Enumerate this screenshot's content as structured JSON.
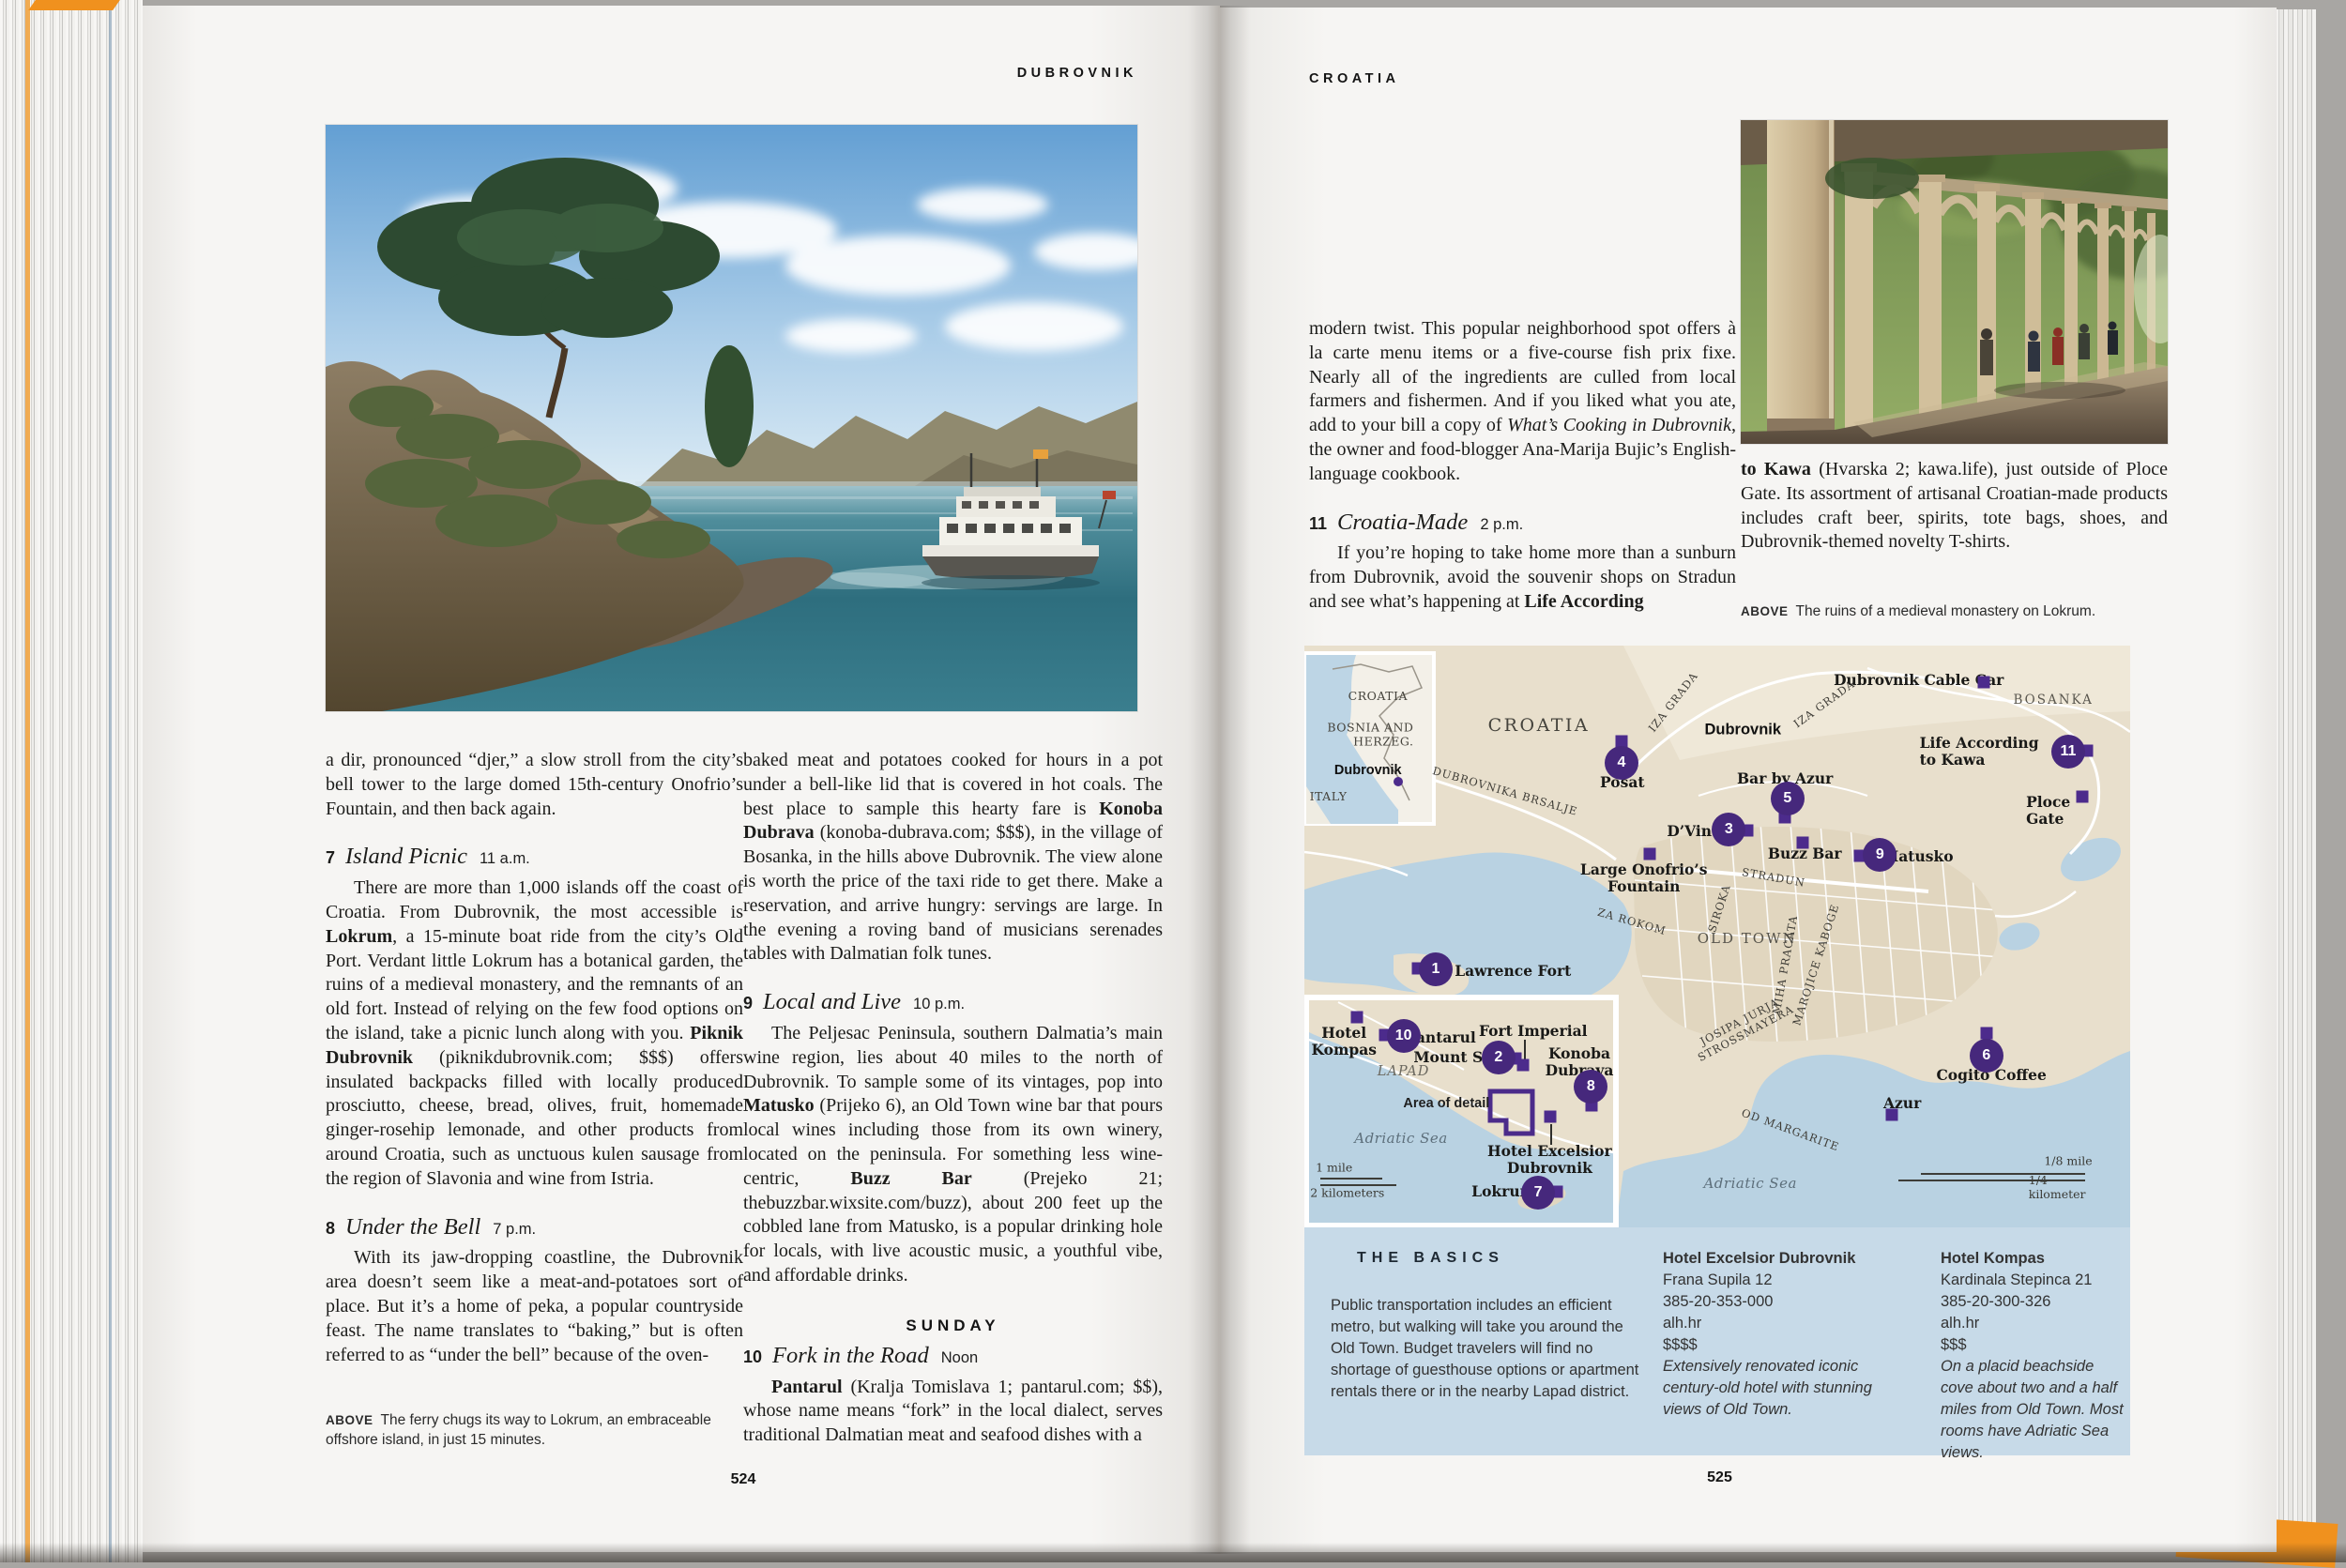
{
  "chrome": {
    "left_header": "DUBROVNIK",
    "right_header": "CROATIA",
    "left_page_number": "524",
    "right_page_number": "525"
  },
  "left_page": {
    "intro": [
      {
        "t": "a dir, pronounced “djer,” a slow stroll from the city’s bell tower to the large domed 15th-century Onofrio’s Fountain, and then back again."
      }
    ],
    "item7": {
      "num": "7",
      "title": "Island Picnic",
      "time": "11 a.m.",
      "body": [
        {
          "t": "There are more than 1,000 islands off the coast of Croatia. From Dubrovnik, the most accessible is "
        },
        {
          "t": "Lokrum",
          "s": "b"
        },
        {
          "t": ", a 15-minute boat ride from the city’s Old Port. Verdant little Lokrum has a botanical garden, the ruins of a medieval monastery, and the remnants of an old fort. Instead of relying on the few food options on the island, take a picnic lunch along with you. "
        },
        {
          "t": "Piknik Dubrovnik",
          "s": "b"
        },
        {
          "t": " (piknikdubrovnik.com; $$$) offers insulated backpacks filled with locally produced prosciutto, cheese, bread, olives, fruit, homemade ginger-rosehip lemonade, and other products from around Croatia, such as unctuous kulen sausage from the region of Slavonia and wine from Istria."
        }
      ]
    },
    "item8": {
      "num": "8",
      "title": "Under the Bell",
      "time": "7 p.m.",
      "body": [
        {
          "t": "With its jaw-dropping coastline, the Dubrovnik area doesn’t seem like a meat-and-potatoes sort of place. But it’s a home of peka, a popular countryside feast. The name translates to “baking,” but is often referred to as “under the bell” because of the oven-"
        }
      ]
    },
    "caption_label": "ABOVE",
    "caption_text": "The ferry chugs its way to Lokrum, an embraceable offshore island, in just 15 minutes.",
    "col2_para": [
      {
        "t": "baked meat and potatoes cooked for hours in a pot under a bell-like lid that is covered in hot coals. The best place to sample this hearty fare is "
      },
      {
        "t": "Konoba Dubrava",
        "s": "b"
      },
      {
        "t": " (konoba-dubrava.com; $$$), in the village of Bosanka, in the hills above Dubrovnik. The view alone is worth the price of the taxi ride to get there. Make a reservation, and arrive hungry: servings are large. In the evening a roving band of musicians serenades tables with Dalmatian folk tunes."
      }
    ],
    "item9": {
      "num": "9",
      "title": "Local and Live",
      "time": "10 p.m.",
      "body": [
        {
          "t": "The Peljesac Peninsula, southern Dalmatia’s main wine region, lies about 40 miles to the north of Dubrovnik. To sample some of its vintages, pop into "
        },
        {
          "t": "Matusko",
          "s": "b"
        },
        {
          "t": " (Prijeko 6), an Old Town wine bar that pours local wines including those from its own winery, located on the peninsula. For something less wine-centric, "
        },
        {
          "t": "Buzz Bar",
          "s": "b"
        },
        {
          "t": " (Prejeko 21; thebuzzbar.wixsite.com/buzz), about 200 feet up the cobbled lane from Matusko, is a popular drinking hole for locals, with live acoustic music, a youthful vibe, and affordable drinks."
        }
      ]
    },
    "sunday_heading": "SUNDAY",
    "item10": {
      "num": "10",
      "title": "Fork in the Road",
      "time": "Noon",
      "body": [
        {
          "t": "Pantarul",
          "s": "b"
        },
        {
          "t": " (Kralja Tomislava 1; pantarul.com; $$), whose name means “fork” in the local dialect, serves traditional Dalmatian meat and seafood dishes with a"
        }
      ]
    }
  },
  "right_page": {
    "col1_para": [
      {
        "t": "modern twist. This popular neighborhood spot offers à la carte menu items or a five-course fish prix fixe. Nearly all of the ingredients are culled from local farmers and fishermen. And if you liked what you ate, add to your bill a copy of "
      },
      {
        "t": "What’s Cooking in Dubrovnik",
        "s": "i"
      },
      {
        "t": ", the owner and food-blogger Ana-Marija Bujic’s English-language cookbook."
      }
    ],
    "item11": {
      "num": "11",
      "title": "Croatia-Made",
      "time": "2 p.m.",
      "body": [
        {
          "t": "If you’re hoping to take home more than a sunburn from Dubrovnik, avoid the souvenir shops on Stradun and see what’s happening at "
        },
        {
          "t": "Life According",
          "s": "b"
        }
      ]
    },
    "col2_para": [
      {
        "t": "to Kawa",
        "s": "b"
      },
      {
        "t": " (Hvarska 2; kawa.life), just outside of Ploce Gate. Its assortment of artisanal Croatian-made products includes craft beer, spirits, tote bags, shoes, and Dubrovnik-themed novelty T-shirts."
      }
    ],
    "caption_label": "ABOVE",
    "caption_text": "The ruins of a medieval monastery on Lokrum."
  },
  "map": {
    "markers": [
      {
        "n": "1",
        "x": 15.9,
        "y": 55.6
      },
      {
        "n": "2",
        "x": 23.5,
        "y": 70.8
      },
      {
        "n": "3",
        "x": 51.4,
        "y": 31.6
      },
      {
        "n": "4",
        "x": 38.4,
        "y": 20.2
      },
      {
        "n": "5",
        "x": 58.5,
        "y": 26.3
      },
      {
        "n": "6",
        "x": 82.6,
        "y": 70.5
      },
      {
        "n": "7",
        "x": 28.3,
        "y": 94.0
      },
      {
        "n": "8",
        "x": 34.7,
        "y": 75.8
      },
      {
        "n": "9",
        "x": 69.7,
        "y": 36.0
      },
      {
        "n": "10",
        "x": 12.0,
        "y": 67.1
      },
      {
        "n": "11",
        "x": 92.5,
        "y": 18.2
      }
    ],
    "squares": [
      {
        "x": 13.8,
        "y": 55.5,
        "name": "square-st-lawrence-fort"
      },
      {
        "x": 25.6,
        "y": 71.0,
        "name": "square-mount-srd"
      },
      {
        "x": 26.5,
        "y": 72.1,
        "name": "square-fort-imperial"
      },
      {
        "x": 53.6,
        "y": 31.8,
        "name": "square-dvino"
      },
      {
        "x": 38.4,
        "y": 16.5,
        "name": "square-posat"
      },
      {
        "x": 58.2,
        "y": 29.5,
        "name": "square-bar-by-azur"
      },
      {
        "x": 82.6,
        "y": 66.6,
        "name": "square-cogito-coffee"
      },
      {
        "x": 30.6,
        "y": 93.9,
        "name": "square-lokrum"
      },
      {
        "x": 34.8,
        "y": 79.0,
        "name": "square-konoba-dubrava"
      },
      {
        "x": 67.3,
        "y": 36.1,
        "name": "square-matusko"
      },
      {
        "x": 9.8,
        "y": 66.9,
        "name": "square-pantarul"
      },
      {
        "x": 94.8,
        "y": 18.0,
        "name": "square-life-according-to-kawa"
      },
      {
        "x": 82.3,
        "y": 6.3,
        "name": "square-dubrovnik-cable-car"
      },
      {
        "x": 94.2,
        "y": 26.0,
        "name": "square-ploce-gate"
      },
      {
        "x": 41.8,
        "y": 35.8,
        "name": "square-onofrio-fountain"
      },
      {
        "x": 60.3,
        "y": 33.9,
        "name": "square-buzz-bar"
      },
      {
        "x": 71.1,
        "y": 80.6,
        "name": "square-azur"
      },
      {
        "x": 29.8,
        "y": 81.0,
        "name": "square-hotel-excelsior"
      },
      {
        "x": 6.4,
        "y": 63.9,
        "name": "square-hotel-kompas"
      },
      {
        "x": 11.4,
        "y": 23.4,
        "cls": "dot",
        "name": "dot-inset-dubrovnik"
      }
    ],
    "labels": [
      {
        "text": "CROATIA",
        "x": 28.4,
        "y": 13.7,
        "cls": "lbl-region",
        "name": "label-croatia-main"
      },
      {
        "text": "Dubrovnik",
        "x": 53.1,
        "y": 14.5,
        "cls": "lbl-city",
        "name": "label-dubrovnik-city"
      },
      {
        "text": "IZA GRADA",
        "x": 44.7,
        "y": 9.7,
        "rot": -52,
        "cls": "lbl-street",
        "name": "label-iza-grada-1"
      },
      {
        "text": "IZA GRADA",
        "x": 63.0,
        "y": 10.0,
        "rot": -36,
        "cls": "lbl-street",
        "name": "label-iza-grada-2"
      },
      {
        "text": "DUBROVNIKA BRSALJE",
        "x": 24.3,
        "y": 25.0,
        "rot": 16,
        "cls": "lbl-street",
        "name": "label-dubrovnika-brsalje"
      },
      {
        "text": "Dubrovnik Cable Car",
        "x": 74.4,
        "y": 6.0,
        "cls": "lbl-poi",
        "name": "label-dubrovnik-cable-car"
      },
      {
        "text": "BOSANKA",
        "x": 90.7,
        "y": 9.4,
        "cls": "lbl-street-lg",
        "name": "label-bosanka"
      },
      {
        "text": "Life According to Kawa",
        "x": 83.0,
        "y": 18.2,
        "cls": "lbl-poi",
        "name": "label-life-according-to-kawa"
      },
      {
        "text": "Bar by Azur",
        "x": 58.2,
        "y": 22.9,
        "cls": "lbl-poi",
        "name": "label-bar-by-azur"
      },
      {
        "text": "D’Vino",
        "x": 47.2,
        "y": 31.9,
        "cls": "lbl-poi",
        "name": "label-dvino"
      },
      {
        "text": "Buzz Bar",
        "x": 60.6,
        "y": 35.8,
        "cls": "lbl-poi",
        "name": "label-buzz-bar"
      },
      {
        "text": "Matusko",
        "x": 74.3,
        "y": 36.3,
        "cls": "lbl-poi",
        "name": "label-matusko"
      },
      {
        "text": "Ploce Gate",
        "x": 91.6,
        "y": 28.4,
        "cls": "lbl-poi",
        "name": "label-ploce-gate"
      },
      {
        "text": "Posat",
        "x": 38.5,
        "y": 23.5,
        "cls": "lbl-poi",
        "name": "label-posat"
      },
      {
        "text": "Large Onofrio’s\nFountain",
        "x": 41.1,
        "y": 40.0,
        "cls": "lbl-poi lbl-center",
        "name": "label-onofrio-fountain"
      },
      {
        "text": "STRADUN",
        "x": 56.8,
        "y": 39.8,
        "rot": 10,
        "cls": "lbl-street",
        "name": "label-stradun"
      },
      {
        "text": "SIROKA",
        "x": 50.2,
        "y": 45.2,
        "rot": -72,
        "cls": "lbl-street",
        "name": "label-siroka"
      },
      {
        "text": "ZA ROKOM",
        "x": 39.7,
        "y": 47.4,
        "rot": 16,
        "cls": "lbl-street",
        "name": "label-za-rokom"
      },
      {
        "text": "OLD TOWN",
        "x": 53.6,
        "y": 50.3,
        "cls": "lbl-area",
        "name": "label-old-town"
      },
      {
        "text": "MIHA PRACATA",
        "x": 58.2,
        "y": 54.8,
        "rot": -80,
        "cls": "lbl-street",
        "name": "label-miha-pracata"
      },
      {
        "text": "MAROJICE KABOGE",
        "x": 61.9,
        "y": 54.8,
        "rot": -72,
        "cls": "lbl-street",
        "name": "label-marojice-kaboge"
      },
      {
        "text": "JOSIPA JURJA\nSTROSSMAYERA",
        "x": 53.1,
        "y": 65.6,
        "rot": -28,
        "cls": "lbl-street lbl-center",
        "name": "label-josipa-jurja-strossmayera"
      },
      {
        "text": "St. Lawrence Fort",
        "x": 23.6,
        "y": 56.0,
        "cls": "lbl-poi",
        "name": "label-st-lawrence-fort"
      },
      {
        "text": "OD MARGARITE",
        "x": 58.9,
        "y": 83.2,
        "rot": 20,
        "cls": "lbl-street",
        "name": "label-od-margarite"
      },
      {
        "text": "Cogito Coffee",
        "x": 83.2,
        "y": 73.9,
        "cls": "lbl-poi",
        "name": "label-cogito-coffee"
      },
      {
        "text": "Azur",
        "x": 72.4,
        "y": 78.7,
        "cls": "lbl-poi",
        "name": "label-azur"
      },
      {
        "text": "Adriatic Sea",
        "x": 54.0,
        "y": 92.4,
        "cls": "lbl-sea",
        "name": "label-adriatic-sea-main"
      },
      {
        "text": "Hotel\nKompas",
        "x": 4.8,
        "y": 68.1,
        "cls": "lbl-poi lbl-center",
        "name": "label-hotel-kompas-map"
      },
      {
        "text": "Pantarul",
        "x": 16.5,
        "y": 67.4,
        "cls": "lbl-poi",
        "name": "label-pantarul"
      },
      {
        "text": "Fort Imperial",
        "x": 27.7,
        "y": 66.3,
        "cls": "lbl-poi",
        "name": "label-fort-imperial"
      },
      {
        "text": "Mount Srd",
        "x": 18.5,
        "y": 70.8,
        "cls": "lbl-poi",
        "name": "label-mount-srd"
      },
      {
        "text": "Konoba\nDubrava",
        "x": 33.3,
        "y": 71.6,
        "cls": "lbl-poi lbl-center",
        "name": "label-konoba-dubrava"
      },
      {
        "text": "LAPAD",
        "x": 12.0,
        "y": 73.2,
        "cls": "lbl-district",
        "name": "label-lapad"
      },
      {
        "text": "Area of detail",
        "x": 17.2,
        "y": 78.7,
        "cls": "lbl-bold-sans",
        "name": "label-area-of-detail"
      },
      {
        "text": "Adriatic Sea",
        "x": 11.7,
        "y": 84.7,
        "cls": "lbl-sea",
        "name": "label-adriatic-sea-inset"
      },
      {
        "text": "Hotel Excelsior\nDubrovnik",
        "x": 29.7,
        "y": 88.4,
        "cls": "lbl-poi lbl-center",
        "name": "label-hotel-excelsior-map"
      },
      {
        "text": "Lokrum",
        "x": 24.1,
        "y": 93.9,
        "cls": "lbl-poi",
        "name": "label-lokrum"
      },
      {
        "text": "1 mile",
        "x": 3.6,
        "y": 89.7,
        "cls": "lbl-scale",
        "name": "label-scale-1-mile"
      },
      {
        "text": "2 kilometers",
        "x": 5.2,
        "y": 94.0,
        "cls": "lbl-scale",
        "name": "label-scale-2-kilometers"
      },
      {
        "text": "1/8 mile",
        "x": 92.5,
        "y": 88.5,
        "cls": "lbl-scale",
        "name": "label-scale-eighth-mile"
      },
      {
        "text": "1/4 kilometer",
        "x": 91.8,
        "y": 93.1,
        "cls": "lbl-scale",
        "name": "label-scale-quarter-kilometer"
      },
      {
        "text": "CROATIA",
        "x": 8.9,
        "y": 8.7,
        "cls": "lbl-inset-region",
        "name": "label-inset-croatia"
      },
      {
        "text": "BOSNIA AND\nHERZEG.",
        "x": 8.0,
        "y": 15.3,
        "cls": "lbl-inset-region lbl-right",
        "name": "label-inset-bosnia-and-herzeg"
      },
      {
        "text": "Dubrovnik",
        "x": 7.7,
        "y": 21.5,
        "cls": "lbl-inset-city",
        "name": "label-inset-dubrovnik"
      },
      {
        "text": "ITALY",
        "x": 2.9,
        "y": 26.0,
        "cls": "lbl-inset-region",
        "name": "label-inset-italy"
      }
    ],
    "leader_lines": [
      {
        "x": 26.6,
        "y": 67.8,
        "h": 3.4,
        "name": "leader-fort-imperial"
      },
      {
        "x": 29.8,
        "y": 82.2,
        "h": 3.6,
        "name": "leader-hotel-excelsior"
      }
    ],
    "scale_lines": [
      {
        "x": 1.9,
        "y": 91.4,
        "w": 7.5,
        "name": "scale-line-1-mile"
      },
      {
        "x": 1.9,
        "y": 92.6,
        "w": 9.2,
        "name": "scale-line-2-kilometers"
      },
      {
        "x": 74.7,
        "y": 90.6,
        "w": 19.9,
        "name": "scale-line-eighth-mile"
      },
      {
        "x": 71.9,
        "y": 91.8,
        "w": 22.6,
        "name": "scale-line-quarter-kilometer"
      }
    ]
  },
  "basics": {
    "title": "THE BASICS",
    "intro": "Public transportation includes an efficient metro, but walking will take you around the Old Town. Budget travelers will find no shortage of guesthouse options or apartment rentals there or in the nearby Lapad district.",
    "hotels": [
      {
        "name": "Hotel Excelsior Dubrovnik",
        "address": "Frana Supila 12",
        "phone": "385-20-353-000",
        "site": "alh.hr",
        "price": "$$$$",
        "desc": "Extensively renovated iconic century-old hotel with stunning views of Old Town."
      },
      {
        "name": "Hotel Kompas",
        "address": "Kardinala Stepinca 21",
        "phone": "385-20-300-326",
        "site": "alh.hr",
        "price": "$$$",
        "desc": "On a placid beachside cove about two and a half miles from Old Town. Most rooms have Adriatic Sea views."
      }
    ]
  }
}
